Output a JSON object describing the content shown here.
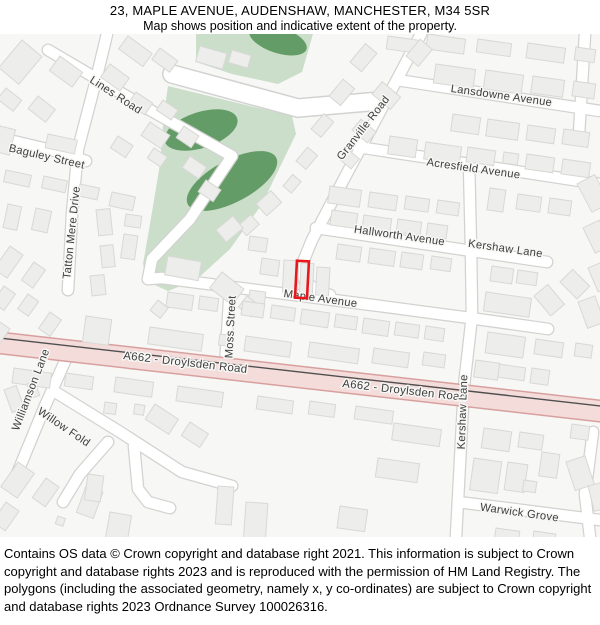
{
  "header": {
    "title": "23, MAPLE AVENUE, AUDENSHAW, MANCHESTER, M34 5SR",
    "subtitle": "Map shows position and indicative extent of the property."
  },
  "map": {
    "street_labels": [
      {
        "name": "Lines Road"
      },
      {
        "name": "Baguley Street"
      },
      {
        "name": "Tatton Mere Drive"
      },
      {
        "name": "Granville Road"
      },
      {
        "name": "Lansdowne Avenue"
      },
      {
        "name": "Acresfield Avenue"
      },
      {
        "name": "Hallworth Avenue"
      },
      {
        "name": "Kershaw Lane"
      },
      {
        "name": "Maple Avenue"
      },
      {
        "name": "Moss Street"
      },
      {
        "name": "A662 - Droylsden Road"
      },
      {
        "name": "A662 - Droylsden Road"
      },
      {
        "name": "Williamson Lane"
      },
      {
        "name": "Willow Fold"
      },
      {
        "name": "Kershaw Lane"
      },
      {
        "name": "Warwick Grove"
      }
    ],
    "marker": {
      "shape": "rectangle",
      "color": "#e8171c"
    },
    "colors": {
      "background": "#f7f7f5",
      "park_light": "#cbdeca",
      "park_dark": "#639c66",
      "building_fill": "#ededeb",
      "building_stroke": "#d8d8d6",
      "road_casing": "#d2d2d0",
      "road_fill": "#ffffff",
      "a_road_fill": "#f4dcda",
      "a_road_border": "#d7a09e",
      "label_color": "#3d3d3d"
    }
  },
  "footer": {
    "copyright": "Contains OS data © Crown copyright and database right 2021. This information is subject to Crown copyright and database rights 2023 and is reproduced with the permission of HM Land Registry. The polygons (including the associated geometry, namely x, y co-ordinates) are subject to Crown copyright and database rights 2023 Ordnance Survey 100026316."
  }
}
